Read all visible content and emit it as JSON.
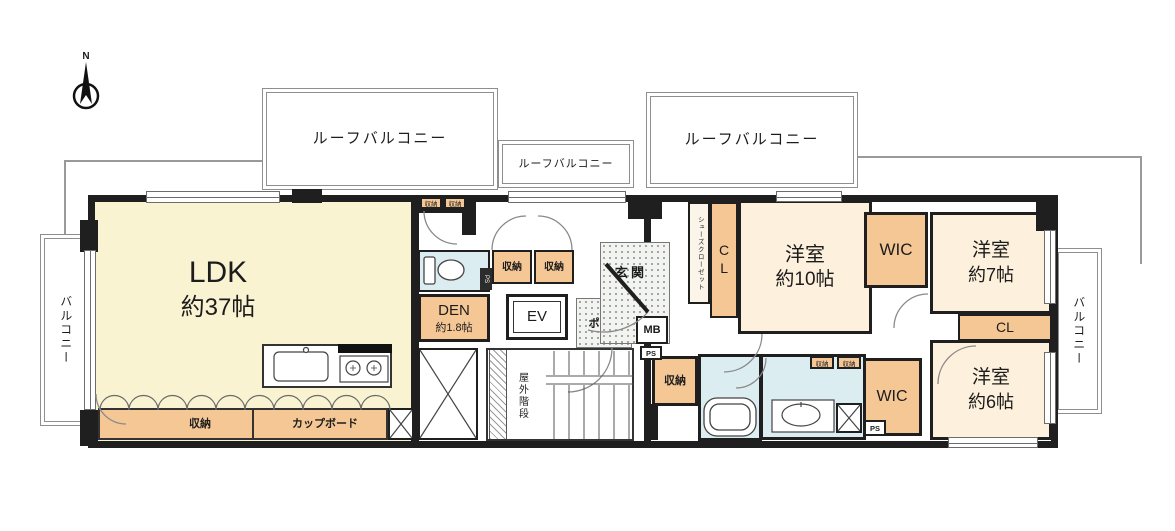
{
  "plan": {
    "compass": {
      "label": "N"
    },
    "balconies": {
      "roof_left": "ルーフバルコニー",
      "roof_center": "ルーフバルコニー",
      "roof_right": "ルーフバルコニー",
      "left": "バルコニー",
      "right": "バルコニー"
    },
    "rooms": {
      "ldk": {
        "name": "LDK",
        "size": "約37帖"
      },
      "den": {
        "name": "DEN",
        "size": "約1.8帖"
      },
      "bedroom10": {
        "name": "洋室",
        "size": "約10帖"
      },
      "bedroom7": {
        "name": "洋室",
        "size": "約7帖"
      },
      "bedroom6": {
        "name": "洋室",
        "size": "約6帖"
      }
    },
    "storage": {
      "wic_bedroom10": "WIC",
      "wic_bedroom6": "WIC",
      "closet_bedroom10": "CL",
      "closet_bedroom6": "CL",
      "shoes_closet": "シューズクローゼット",
      "hall_storage": "収納",
      "ldk_storage": "収納",
      "cupboard": "カップボード",
      "top_storage_a": "収納",
      "top_storage_b": "収納",
      "corridor_storage_a": "収納",
      "corridor_storage_b": "収納",
      "wash_storage_a": "収納",
      "wash_storage_b": "収納"
    },
    "service": {
      "entrance": "玄関",
      "porch": "ポーチ",
      "elevator": "EV",
      "meter_box": "MB",
      "ps_entrance": "PS",
      "ps_wash": "PS",
      "ps_toilet": "PS",
      "outdoor_stairs": "屋外階段"
    },
    "colors": {
      "ldk_fill": "#faf3d2",
      "bedroom_fill": "#fdf0dc",
      "storage_fill": "#f4c795",
      "wet_area_fill": "#dcedf1",
      "wall": "#1f1f1f"
    }
  }
}
